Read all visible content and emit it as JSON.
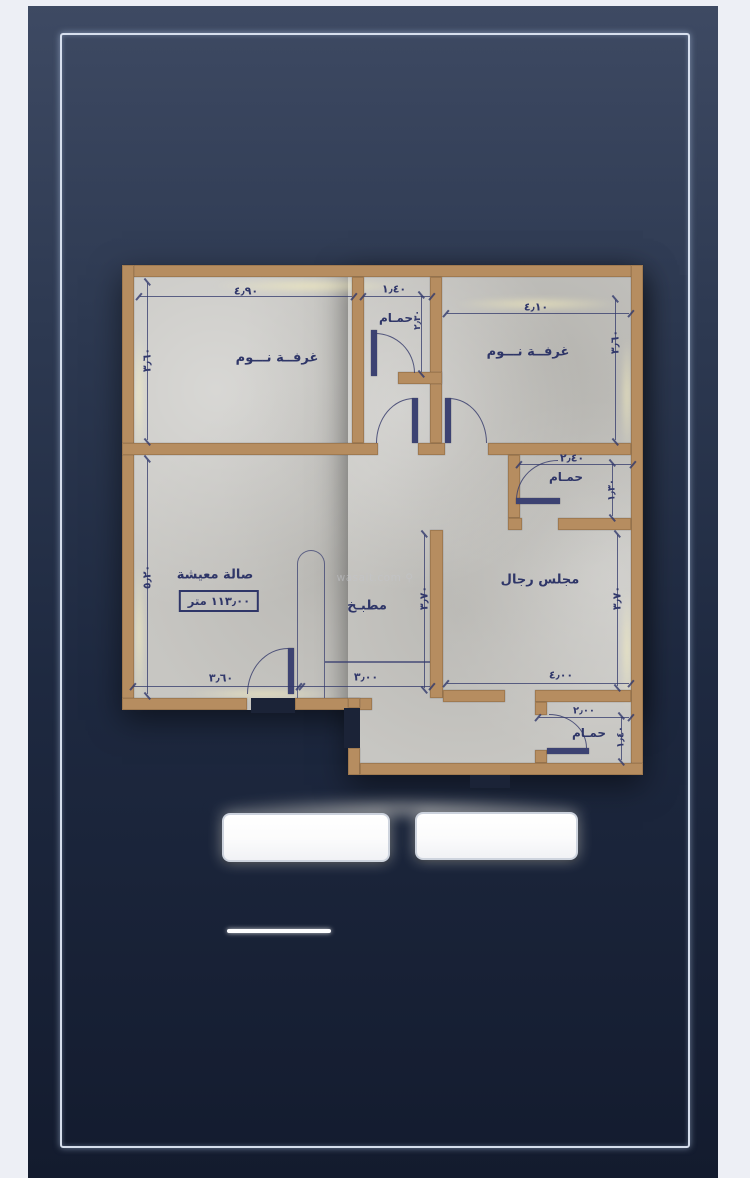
{
  "watermark": {
    "text": "wasait.com",
    "pin_icon": "⚲"
  },
  "rooms": {
    "bedroom_top_left": {
      "label": "غرفــة نـــوم"
    },
    "bedroom_top_right": {
      "label": "غرفــة نـــوم"
    },
    "bathroom_top": {
      "label": "حمـام"
    },
    "bathroom_middle": {
      "label": "حمـام"
    },
    "bathroom_bottom": {
      "label": "حمـام"
    },
    "living_room": {
      "label": "صالة معيشة",
      "area_label": "١١٣٫٠٠ متر"
    },
    "kitchen": {
      "label": "مطبـخ"
    },
    "majlis": {
      "label": "مجلس رجال"
    }
  },
  "dimensions": {
    "bedroom_tl_width": "٤٫٩٠",
    "bathroom_top_width": "١٫٤٠",
    "bedroom_tr_width": "٤٫١٠",
    "bedroom_tl_height": "٣٫٦٠",
    "bedroom_tr_height": "٣٫٦٠",
    "bathroom_top_height": "٢٫٣٠",
    "bathroom_mid_width": "٢٫٤٠",
    "bathroom_mid_height": "١٫٣٠",
    "living_height": "٥٫٢٠",
    "kitchen_height": "٣٫٧٠",
    "majlis_height": "٣٫٧٠",
    "living_bottom_width": "٣٫٦٠",
    "kitchen_bottom_width": "٣٫٠٠",
    "majlis_bottom_width": "٤٫٠٠",
    "bathroom_bottom_width": "٢٫٠٠",
    "bathroom_bottom_height": "١٫٤٠"
  },
  "colors": {
    "wall": "#b68d60",
    "floor": "#c7c6c2",
    "ink": "#31386b",
    "background_top": "#3e4a63",
    "background_bottom": "#131b2e",
    "frame_line": "#dfe8f5",
    "outer_mat": "#edeff5"
  }
}
